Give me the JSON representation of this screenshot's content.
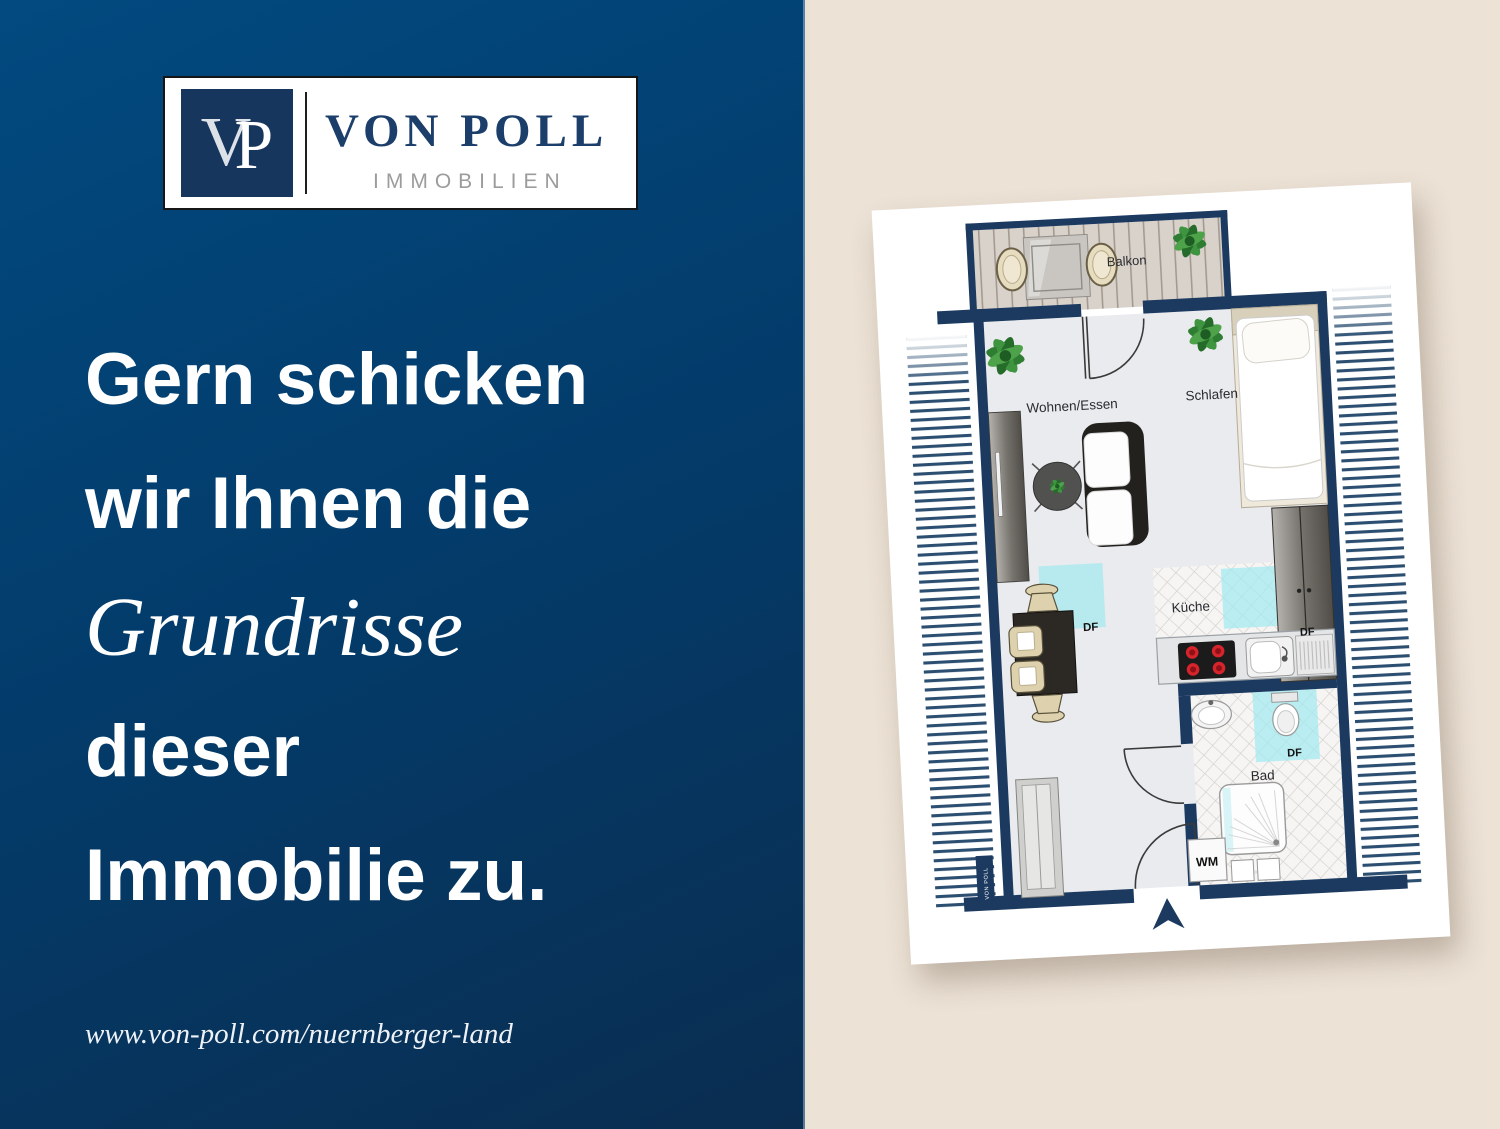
{
  "brand": {
    "monogram_v": "V",
    "monogram_p": "P",
    "name": "VON POLL",
    "subtitle": "IMMOBILIEN"
  },
  "headline": {
    "line1": "Gern schicken",
    "line2": "wir Ihnen die",
    "line3": "Grundrisse",
    "line4": "dieser",
    "line5": "Immobilie zu."
  },
  "footer": {
    "url": "www.von-poll.com/nuernberger-land"
  },
  "floorplan": {
    "labels": {
      "balcony": "Balkon",
      "living_dining": "Wohnen/Essen",
      "sleeping": "Schlafen",
      "kitchen": "Küche",
      "bath": "Bad",
      "roof_window": "DF",
      "washing_machine": "WM"
    },
    "watermark": "VON POLL"
  },
  "colors": {
    "panel_blue_top": "#024a80",
    "panel_blue_bottom": "#0a2d50",
    "panel_beige": "#ece2d6",
    "wall_navy": "#1c3a60",
    "logo_navy": "#16365d",
    "logo_gray": "#9c9c9c",
    "skylight_cyan": "#9fe9ef",
    "sheet_white": "#ffffff"
  }
}
